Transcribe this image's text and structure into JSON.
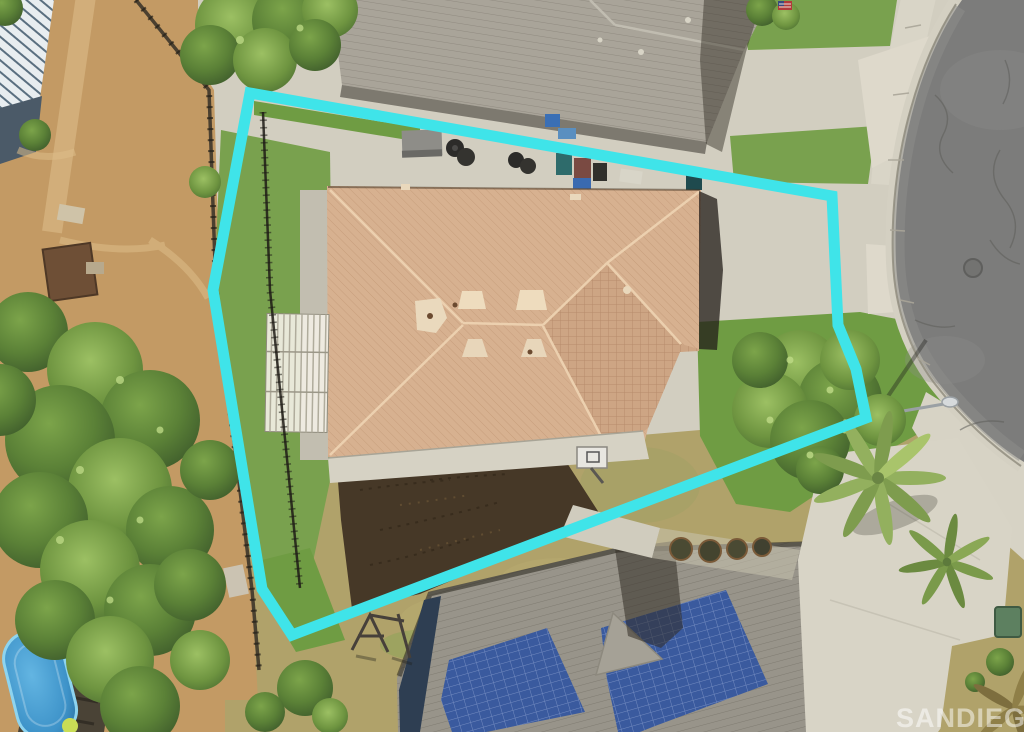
{
  "watermark": {
    "text": "SANDIEGO|MLS"
  },
  "boundary": {
    "name": "property-boundary-overlay",
    "points": "250,93 832,196 838,325 856,369 866,418 292,635 262,589 213,290",
    "color": "#3FE4E9",
    "stroke_width": 11
  },
  "palette": {
    "dirt": "#c39a64",
    "dirt_light": "#dcbd88",
    "tree_dark": "#3d5a2b",
    "tree_mid": "#5b8137",
    "tree_light": "#7ca44a",
    "tree_hilite": "#bcd884",
    "grass": "#79a14e",
    "grass_bright": "#6f9c43",
    "grass_dry": "#b0a26a",
    "concrete": "#d2cec0",
    "concrete_bright": "#ded9cb",
    "concrete_dim": "#c2beb0",
    "asphalt": "#7c7c7b",
    "asphalt_light": "#8d8d8b",
    "roof_tan": "#d7b190",
    "roof_tan_dark": "#cda584",
    "roof_ridge": "#eed4b2",
    "roof_gray": "#a9a499",
    "roof_gray_dark": "#98948a",
    "solar": "#3a5a9e",
    "solar_dark": "#2e3e52",
    "pool": "#3e93c9",
    "pool_light": "#63b5e2",
    "bed_soil": "#463827",
    "watermark": "rgba(255,255,255,0.5)"
  },
  "regions": [
    "left-yard-trees",
    "neighbor-house-top",
    "main-house-roof",
    "front-lawn",
    "back-lawn",
    "garden-bed",
    "street-cul-de-sac",
    "sidewalk",
    "neighbor-house-bottom",
    "solar-panels",
    "swimming-pool",
    "palm-trees",
    "driveway",
    "street-light",
    "basketball-hoop",
    "pergola",
    "playground",
    "utility-box",
    "trash-bins",
    "pool-deck",
    "fence",
    "manhole"
  ]
}
